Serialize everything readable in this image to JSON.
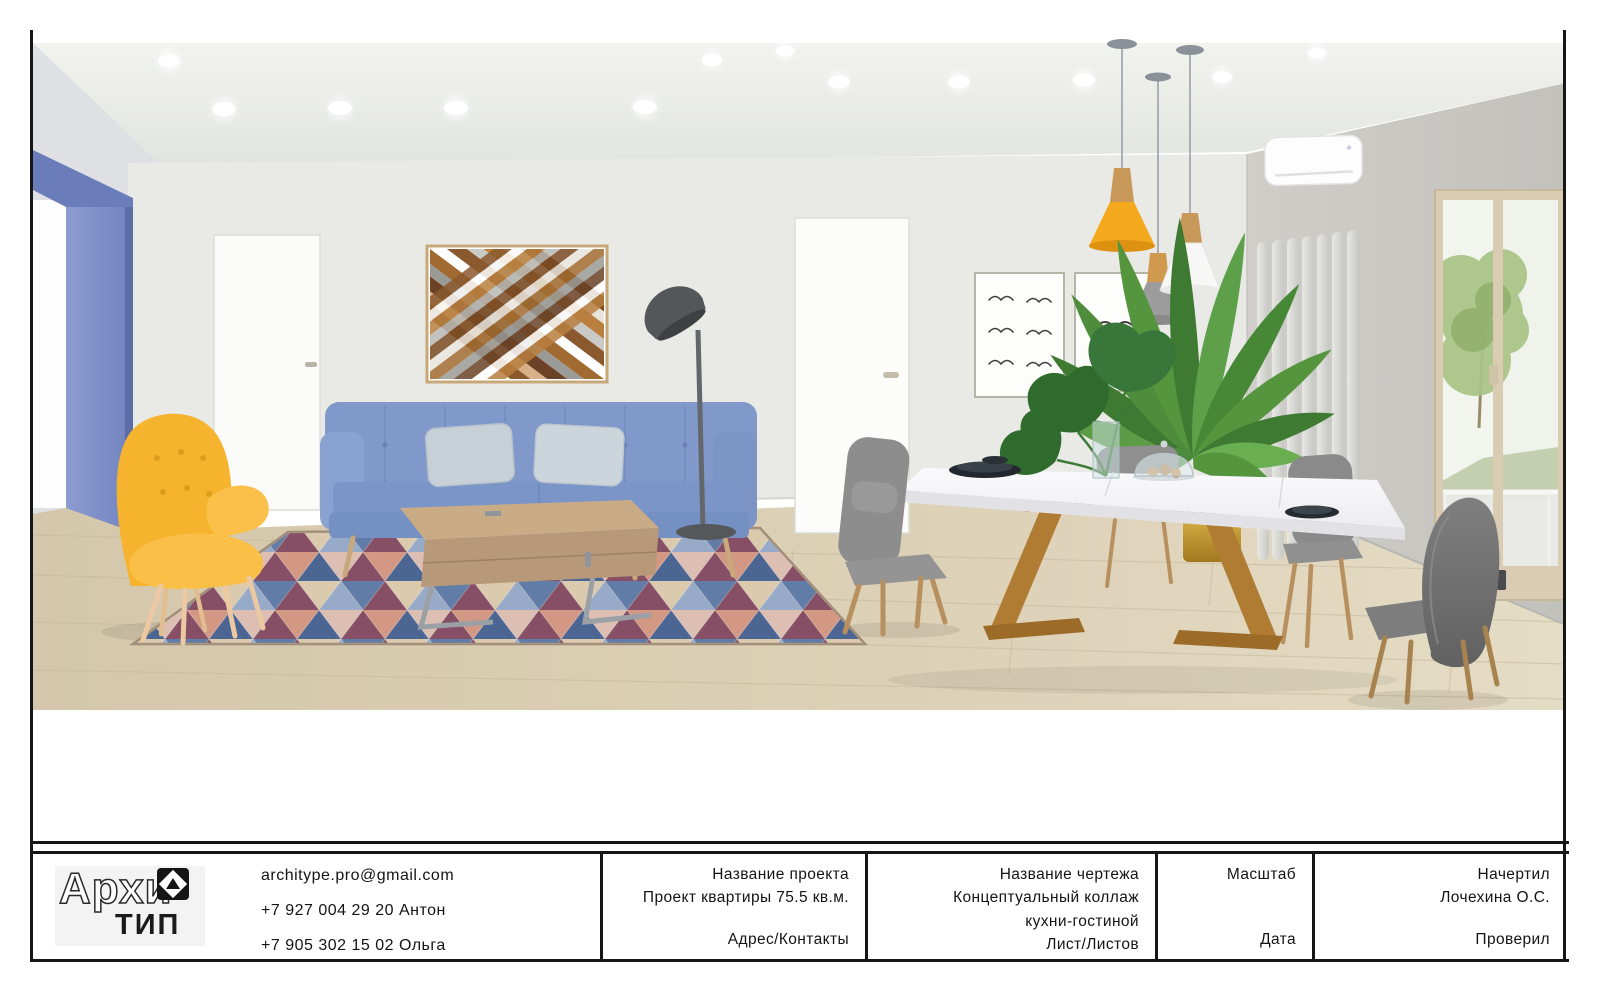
{
  "sheet": {
    "border_color": "#161616",
    "background": "#ffffff"
  },
  "title_block": {
    "logo": {
      "text_outline": "Архи",
      "text_solid": "ТИП",
      "icon": "diamond-triangle-logo"
    },
    "contacts": {
      "lines": [
        "architype.pro@gmail.com",
        "+7 927 004 29 20 Антон",
        "+7 905 302 15 02 Ольга"
      ]
    },
    "project_col": {
      "label": "Название проекта",
      "value": "Проект квартиры 75.5 кв.м.",
      "footer": "Адрес/Контакты"
    },
    "drawing_col": {
      "label": "Название чертежа",
      "value_line1": "Концептуальный коллаж",
      "value_line2": "кухни-гостиной",
      "footer": "Лист/Листов"
    },
    "scale_col": {
      "label": "Масштаб",
      "footer": "Дата"
    },
    "author_col": {
      "label": "Начертил",
      "value": "Лочехина О.С.",
      "footer": "Проверил"
    }
  },
  "scene": {
    "description": "Concept collage of a kitchen-living room interior",
    "elements": [
      "recessed-ceiling-lights",
      "blue-accent-doorway",
      "interior-door-left",
      "interior-door-right",
      "geometric-wood-wall-art",
      "framed-bird-prints",
      "floor-lamp",
      "blue-sofa",
      "throw-pillows",
      "oak-coffee-table",
      "triangle-pattern-rug",
      "yellow-wing-armchair",
      "pendant-lamp-yellow",
      "pendant-lamp-gray",
      "pendant-lamp-white",
      "air-conditioner",
      "vertical-radiator",
      "areca-palm-plant",
      "monstera-leaves",
      "white-dining-table",
      "gray-dining-chairs",
      "dark-plates",
      "glass-vase",
      "glass-dome-with-cookies",
      "gold-planter",
      "balcony-window",
      "tree-view-outside",
      "wood-floor"
    ],
    "colors": {
      "accent_wall_blue": "#7486c2",
      "sofa_blue": "#8099ca",
      "armchair_yellow": "#f6b42e",
      "pendant_yellow": "#f4a81c",
      "floor_wood": "#d9cdb2",
      "rug_navy": "#3d5a8a",
      "rug_maroon": "#7c4058",
      "table_leg_wood": "#b07c33",
      "chair_gray": "#8d8d8d"
    }
  }
}
